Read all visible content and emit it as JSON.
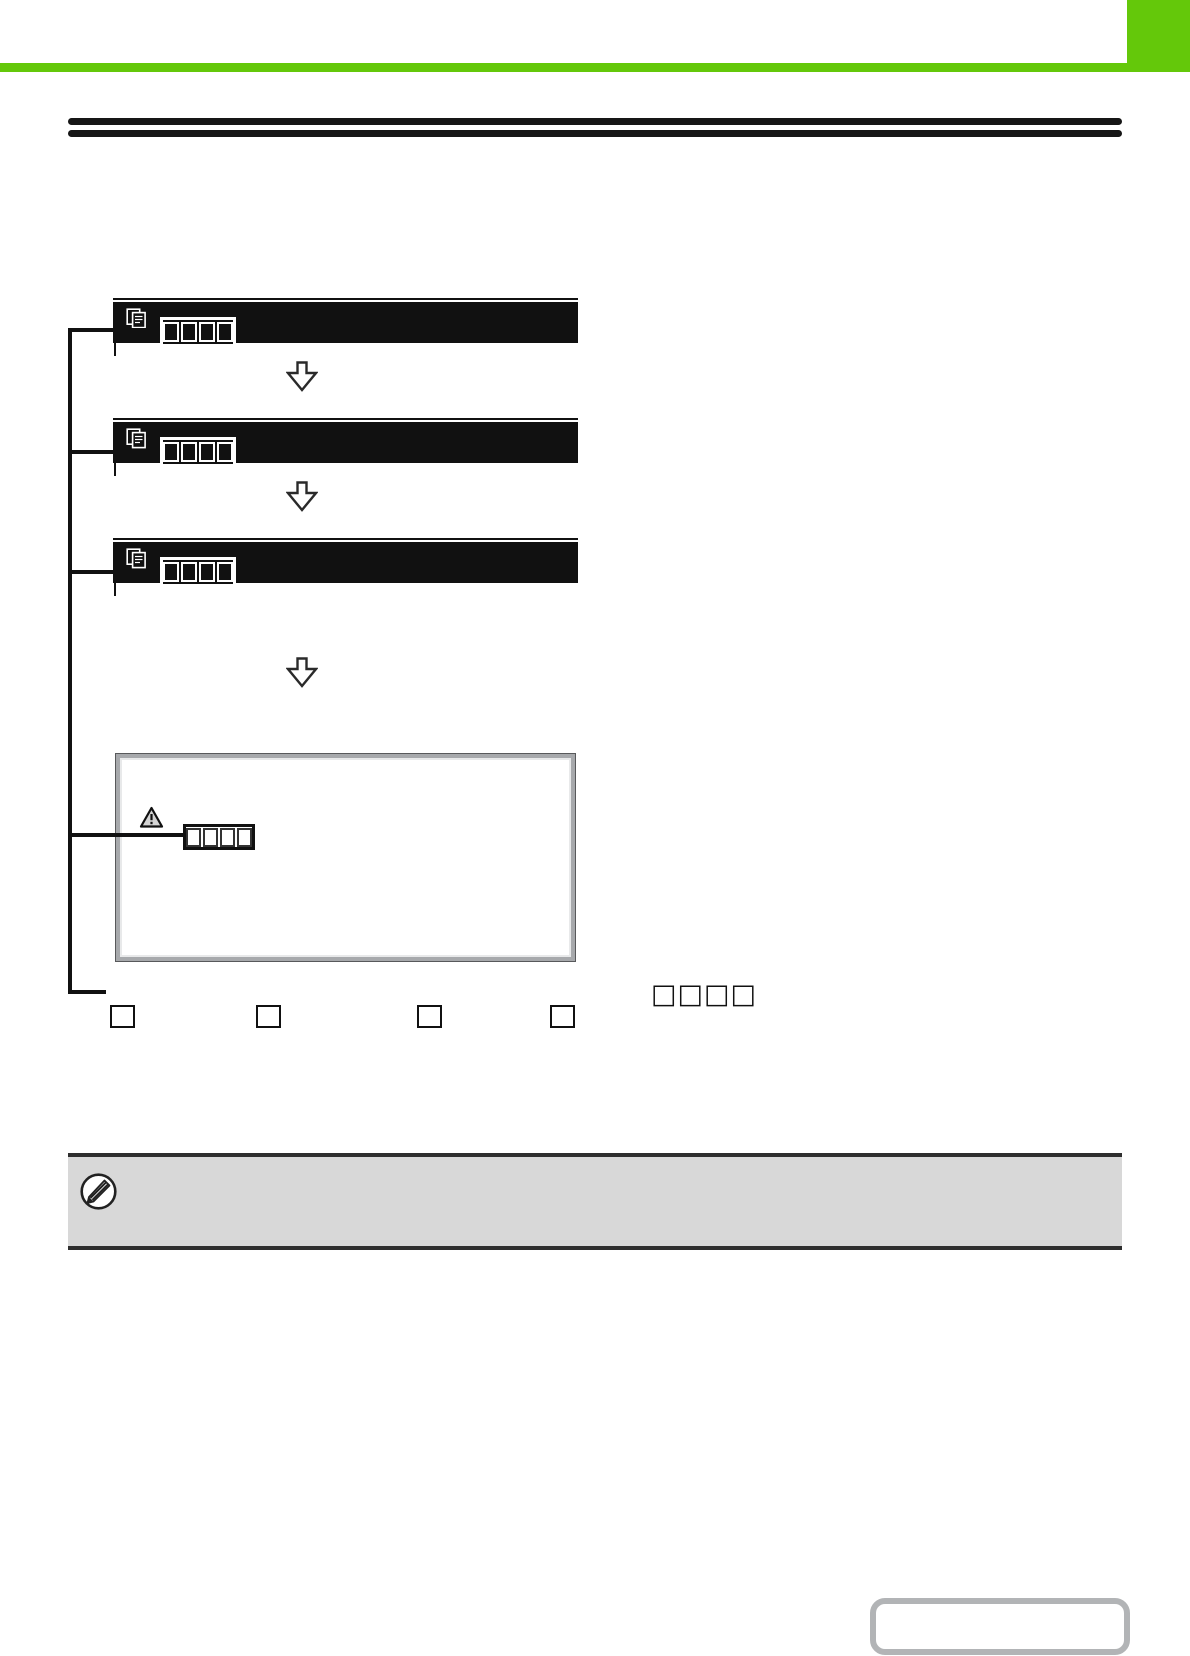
{
  "page": {
    "background": "#ffffff",
    "accent_green": "#64c80a",
    "rule_color": "#161616",
    "note_background": "#d8d8d8",
    "readable_text": ""
  },
  "flow_diagram": {
    "screens": [
      {
        "name": "panel-screen-1",
        "icon": "copies-icon",
        "display_slots": 4
      },
      {
        "name": "panel-screen-2",
        "icon": "copies-icon",
        "display_slots": 4
      },
      {
        "name": "panel-screen-3",
        "icon": "copies-icon",
        "display_slots": 4
      }
    ],
    "arrows": 3,
    "message_box": {
      "icon": "warning-triangle-icon",
      "display_slots": 4
    }
  },
  "callouts": {
    "square_count": 4,
    "tofu_text": "□□□□"
  },
  "note_bar": {
    "icon": "pencil-note-icon",
    "text": ""
  },
  "footer": {
    "nav_box_label": ""
  }
}
